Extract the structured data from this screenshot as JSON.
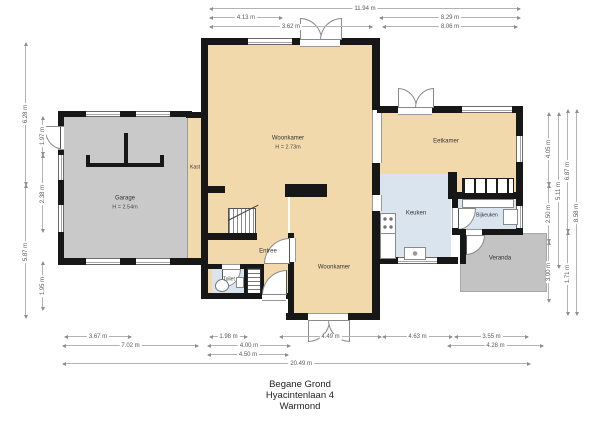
{
  "title": {
    "lines": [
      "Begane Grond",
      "Hyacintenlaan 4",
      "Warmond"
    ]
  },
  "rooms": {
    "woonkamer_top": {
      "name": "Woonkamer",
      "height": "H = 2.73m"
    },
    "woonkamer_bottom": {
      "name": "Woonkamer"
    },
    "garage": {
      "name": "Garage",
      "height": "H = 2.54m"
    },
    "eetkamer": {
      "name": "Eetkamer"
    },
    "keuken": {
      "name": "Keuken"
    },
    "bijkeuken": {
      "name": "Bijkeuken"
    },
    "veranda": {
      "name": "Veranda"
    },
    "entree": {
      "name": "Entree"
    },
    "toilet": {
      "name": "Toilet"
    },
    "kast": {
      "name": "Kast"
    }
  },
  "dims": {
    "top": [
      {
        "label": "11.94 m"
      },
      {
        "label": "4.13 m"
      },
      {
        "label": "8.29 m"
      },
      {
        "label": "3.62 m"
      },
      {
        "label": "8.06 m"
      }
    ],
    "left": [
      {
        "label": "6.28 m"
      },
      {
        "label": "5.87 m"
      },
      {
        "label": "1.97 m"
      },
      {
        "label": "2.38 m"
      },
      {
        "label": "1.95 m"
      }
    ],
    "right": [
      {
        "label": "4.05 m"
      },
      {
        "label": "2.50 m"
      },
      {
        "label": "3.00 m"
      },
      {
        "label": "5.11 m"
      },
      {
        "label": "6.87 m"
      },
      {
        "label": "1.71 m"
      },
      {
        "label": "8.58 m"
      }
    ],
    "bottom": [
      {
        "label": "3.67 m"
      },
      {
        "label": "1.98 m"
      },
      {
        "label": "4.49 m"
      },
      {
        "label": "4.63 m"
      },
      {
        "label": "3.55 m"
      },
      {
        "label": "7.02 m"
      },
      {
        "label": "4.00 m"
      },
      {
        "label": "4.28 m"
      },
      {
        "label": "4.50 m"
      },
      {
        "label": "20.49 m"
      }
    ]
  },
  "colors": {
    "room_fill": "#f2d9ac",
    "utility_fill": "#dae4ee",
    "garage_fill": "#c9c9c9",
    "veranda_fill": "#c3c3c3",
    "wall": "#171717",
    "dimension": "#8f8f8f"
  }
}
